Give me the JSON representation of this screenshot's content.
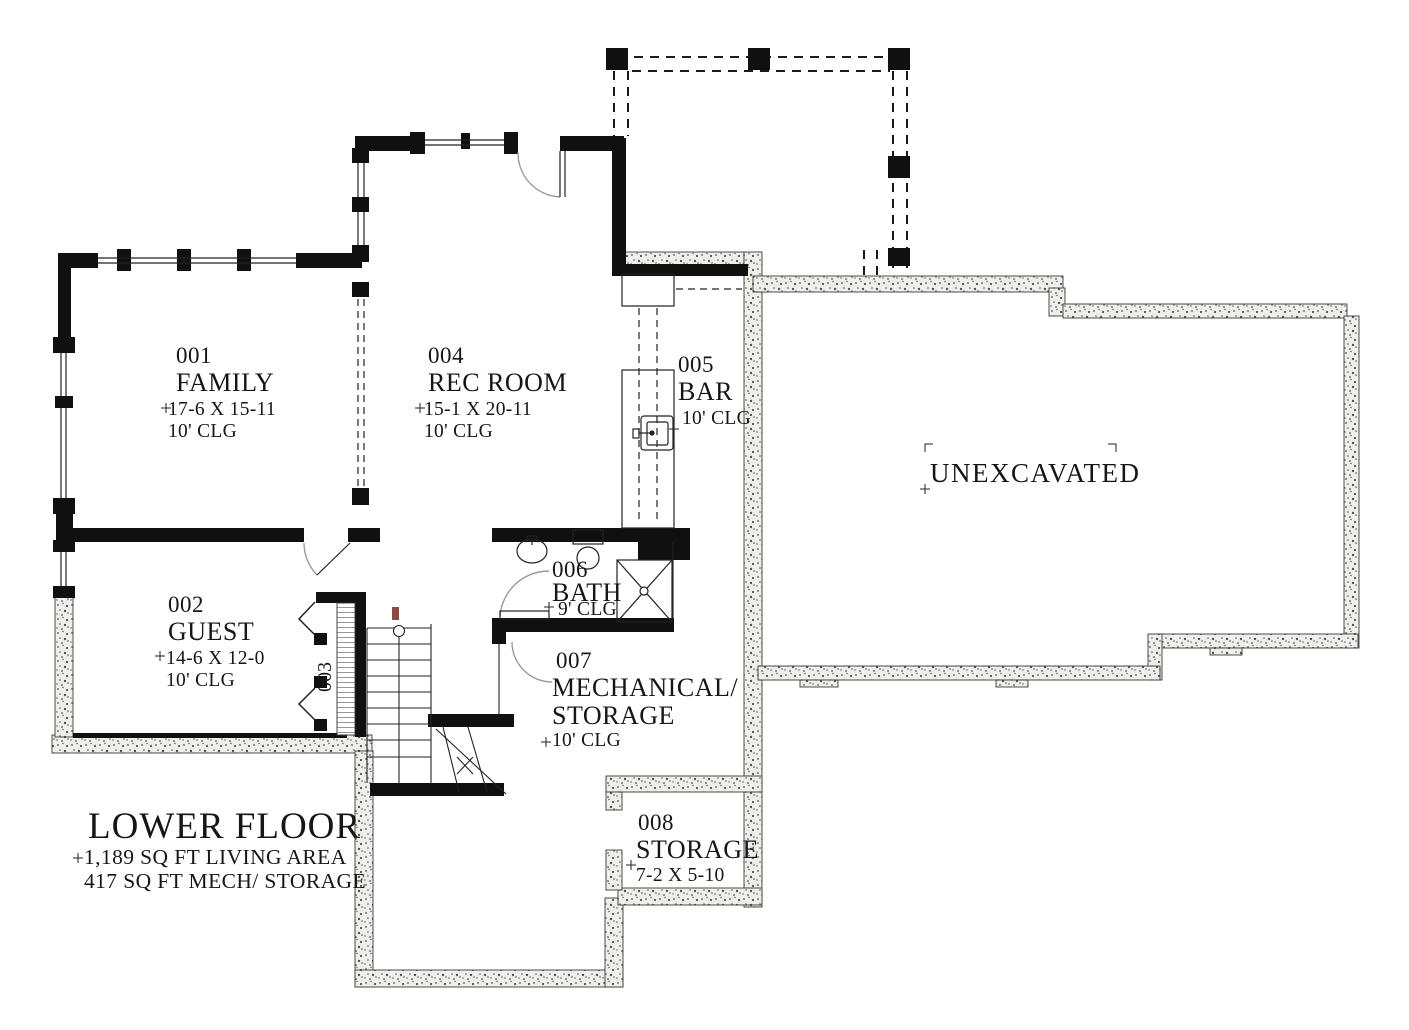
{
  "title_block": {
    "title": "LOWER FLOOR",
    "line1": "1,189 SQ FT LIVING AREA",
    "line2": "417 SQ FT MECH/ STORAGE"
  },
  "areas": {
    "unexcavated": "UNEXCAVATED"
  },
  "rooms": {
    "family": {
      "number": "001",
      "name": "FAMILY",
      "dims": "17-6 X 15-11",
      "ceiling": "10' CLG"
    },
    "guest": {
      "number": "002",
      "name": "GUEST",
      "dims": "14-6 X 12-0",
      "ceiling": "10' CLG"
    },
    "closet": {
      "number": "003"
    },
    "rec": {
      "number": "004",
      "name": "REC ROOM",
      "dims": "15-1 X 20-11",
      "ceiling": "10' CLG"
    },
    "bar": {
      "number": "005",
      "name": "BAR",
      "ceiling": "10' CLG"
    },
    "bath": {
      "number": "006",
      "name": "BATH",
      "ceiling": "9' CLG"
    },
    "mech": {
      "number": "007",
      "name_line1": "MECHANICAL/",
      "name_line2": "STORAGE",
      "ceiling": "10' CLG"
    },
    "storage": {
      "number": "008",
      "name": "STORAGE",
      "dims": "7-2 X 5-10"
    }
  },
  "colors": {
    "wall": "#101010",
    "line": "#222222",
    "door_arc": "#9a9a9a",
    "stipple": "#55524c",
    "red_mark": "#8d4a43"
  }
}
